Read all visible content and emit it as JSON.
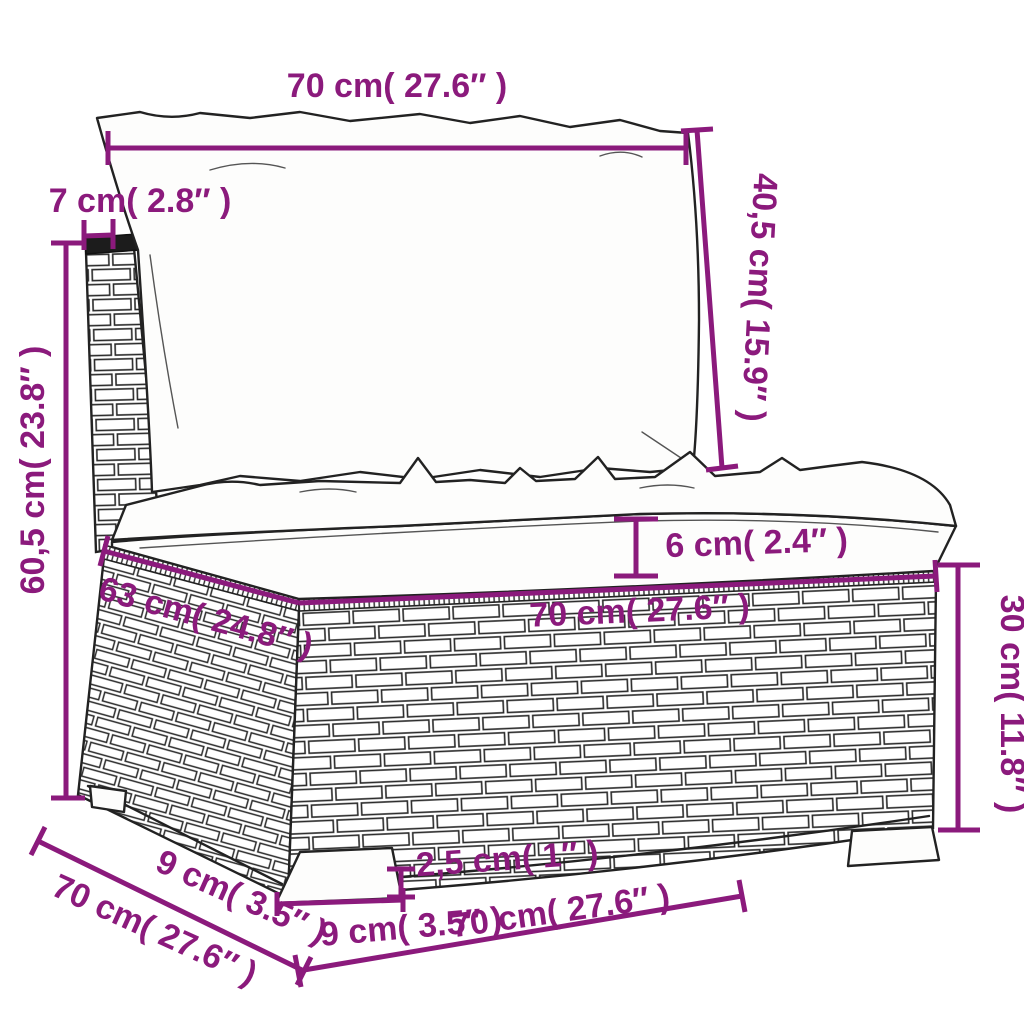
{
  "diagram": {
    "title": "sofa-section-dimension-diagram",
    "accent_color": "#8B1A7C",
    "line_color": "#222222",
    "background_color": "#ffffff",
    "labels": {
      "top_width": "70 cm( 27.6″ )",
      "back_frame_depth": "7 cm( 2.8″ )",
      "total_height": "60,5 cm( 23.8″ )",
      "back_cushion_height": "40,5 cm( 15.9″ )",
      "cushion_thickness": "6 cm( 2.4″ )",
      "seat_depth": "63 cm( 24.8″ )",
      "seat_width": "70 cm( 27.6″ )",
      "base_height": "30 cm( 11.8″ )",
      "leg_depth": "9 cm( 3.5″ )",
      "base_depth": "70 cm( 27.6″ )",
      "leg_height": "2,5 cm( 1″ )",
      "leg_width": "9 cm( 3.5″ )",
      "bottom_width": "70 cm( 27.6″ )"
    }
  }
}
